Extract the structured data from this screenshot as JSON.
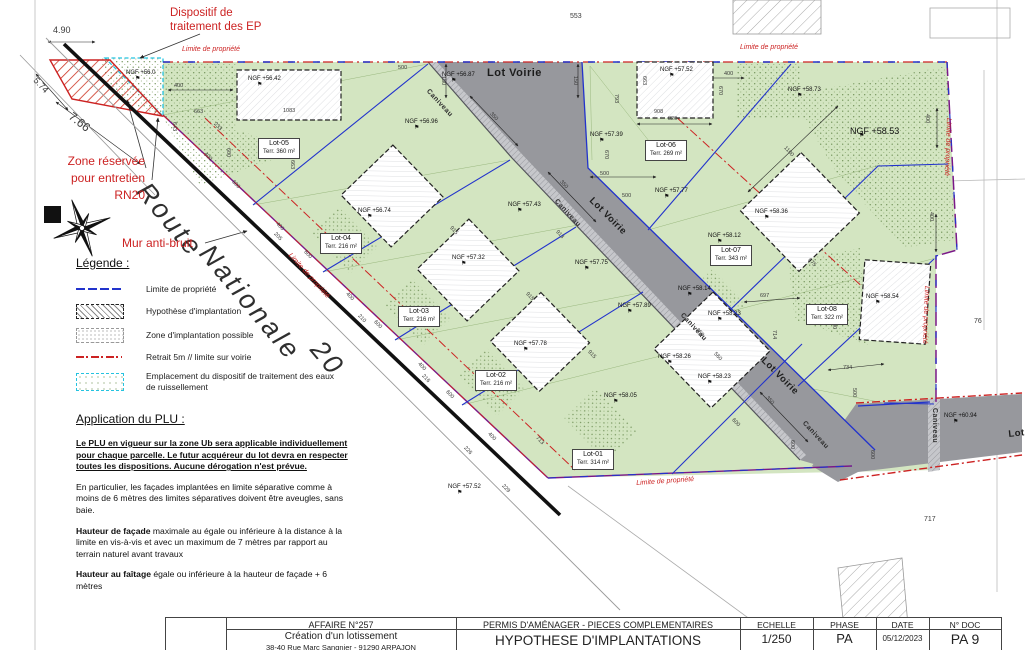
{
  "colors": {
    "red": "#cc2222",
    "blue": "#2233cc",
    "cyan": "#25c3e0",
    "purple": "#7a1888",
    "green_fill": "#d3e5c1",
    "road_gray": "#97989d"
  },
  "annotations": {
    "dispositif_l1": "Dispositif de",
    "dispositif_l2": "traitement des EP",
    "zone_l1": "Zone réservée",
    "zone_l2": "pour entretien",
    "zone_l3": "RN20",
    "mur": "Mur anti-bruit",
    "route": [
      "Route",
      "Nationale",
      "20"
    ]
  },
  "plan": {
    "limite_text": "Limite de propriété",
    "limite_positions": [
      [
        182,
        46,
        0
      ],
      [
        740,
        44,
        0
      ],
      [
        952,
        118,
        92
      ],
      [
        930,
        286,
        92
      ],
      [
        292,
        252,
        48
      ],
      [
        636,
        480,
        -4
      ]
    ],
    "lot_voirie_text": "Lot Voirie",
    "lot_voirie_positions": [
      [
        487,
        68,
        0,
        11
      ],
      [
        594,
        196,
        45,
        9.5
      ],
      [
        766,
        356,
        45,
        9.5
      ],
      [
        1008,
        430,
        -6,
        9.5
      ]
    ],
    "caniveau_text": "Caniveau",
    "caniveau_positions": [
      [
        430,
        88,
        47
      ],
      [
        558,
        198,
        47
      ],
      [
        684,
        312,
        47
      ],
      [
        806,
        420,
        47
      ],
      [
        938,
        408,
        90
      ]
    ],
    "route_positions": [
      [
        152,
        178,
        50
      ],
      [
        215,
        240,
        50
      ],
      [
        326,
        336,
        50
      ]
    ],
    "lots": [
      [
        "Lot-05",
        "Terr. 360 m²",
        258,
        138
      ],
      [
        "Lot-04",
        "Terr. 216 m²",
        320,
        233
      ],
      [
        "Lot-03",
        "Terr. 216 m²",
        398,
        306
      ],
      [
        "Lot-02",
        "Terr. 216 m²",
        475,
        370
      ],
      [
        "Lot-01",
        "Terr. 314 m²",
        572,
        449
      ],
      [
        "Lot-06",
        "Terr. 269 m²",
        645,
        140
      ],
      [
        "Lot-07",
        "Terr. 343 m²",
        710,
        245
      ],
      [
        "Lot-08",
        "Terr. 322 m²",
        806,
        304
      ]
    ],
    "ngf": [
      [
        "NGF +56.0",
        126,
        70
      ],
      [
        "NGF +56.42",
        248,
        76
      ],
      [
        "NGF +56.87",
        442,
        72
      ],
      [
        "NGF +57.52",
        660,
        67
      ],
      [
        "NGF +56.96",
        405,
        119
      ],
      [
        "NGF +57.39",
        590,
        132
      ],
      [
        "NGF +56.74",
        358,
        208
      ],
      [
        "NGF +57.43",
        508,
        202
      ],
      [
        "NGF +57.32",
        452,
        255
      ],
      [
        "NGF +57.77",
        655,
        188
      ],
      [
        "NGF +57.75",
        575,
        260
      ],
      [
        "NGF +57.78",
        514,
        341
      ],
      [
        "NGF +57.89",
        618,
        303
      ],
      [
        "NGF +58.26",
        658,
        354
      ],
      [
        "NGF +58.05",
        604,
        393
      ],
      [
        "NGF +57.52",
        448,
        484
      ],
      [
        "NGF +58.73",
        788,
        87
      ],
      [
        "NGF +58.53",
        850,
        127,
        9
      ],
      [
        "NGF +58.36",
        755,
        209
      ],
      [
        "NGF +58.12",
        708,
        233
      ],
      [
        "NGF +58.14",
        678,
        286
      ],
      [
        "NGF +58.23",
        708,
        311
      ],
      [
        "NGF +58.23",
        698,
        374
      ],
      [
        "NGF +58.54",
        866,
        294
      ],
      [
        "NGF +60.94",
        944,
        413
      ]
    ],
    "dims": [
      [
        "4.90",
        53,
        26,
        0,
        9
      ],
      [
        "5.74",
        38,
        76,
        47,
        9
      ],
      [
        "7.66",
        74,
        110,
        38,
        12
      ],
      [
        "400",
        174,
        84,
        0
      ],
      [
        "663",
        194,
        110,
        0
      ],
      [
        "1083",
        283,
        109,
        0
      ],
      [
        "643",
        176,
        122,
        90
      ],
      [
        "663",
        294,
        160,
        90
      ],
      [
        "600",
        230,
        148,
        90
      ],
      [
        "400",
        206,
        152,
        47
      ],
      [
        "600",
        234,
        180,
        47
      ],
      [
        "400",
        278,
        222,
        47
      ],
      [
        "600",
        306,
        250,
        47
      ],
      [
        "400",
        348,
        292,
        47
      ],
      [
        "600",
        376,
        320,
        47
      ],
      [
        "400",
        420,
        362,
        47
      ],
      [
        "600",
        448,
        390,
        47
      ],
      [
        "400",
        490,
        432,
        47
      ],
      [
        "915",
        452,
        226,
        47
      ],
      [
        "913",
        558,
        230,
        47
      ],
      [
        "915",
        528,
        292,
        47
      ],
      [
        "915",
        590,
        350,
        47
      ],
      [
        "713",
        538,
        436,
        47
      ],
      [
        "350",
        492,
        112,
        47
      ],
      [
        "350",
        562,
        180,
        47
      ],
      [
        "350",
        698,
        328,
        47
      ],
      [
        "350",
        768,
        396,
        47
      ],
      [
        "150",
        445,
        76,
        90
      ],
      [
        "150",
        577,
        76,
        90
      ],
      [
        "500",
        398,
        66,
        0
      ],
      [
        "500",
        600,
        172,
        0
      ],
      [
        "820",
        668,
        117,
        0
      ],
      [
        "908",
        654,
        110,
        0
      ],
      [
        "670",
        722,
        86,
        90
      ],
      [
        "670",
        608,
        150,
        90
      ],
      [
        "793",
        618,
        94,
        90
      ],
      [
        "663",
        646,
        76,
        90
      ],
      [
        "400",
        724,
        72,
        0
      ],
      [
        "400",
        929,
        114,
        90
      ],
      [
        "400",
        933,
        212,
        90
      ],
      [
        "500",
        622,
        194,
        0
      ],
      [
        "1100",
        786,
        146,
        47
      ],
      [
        "675",
        810,
        258,
        47
      ],
      [
        "697",
        760,
        294,
        0
      ],
      [
        "734",
        843,
        366,
        0
      ],
      [
        "714",
        776,
        330,
        90
      ],
      [
        "500",
        836,
        320,
        90
      ],
      [
        "560",
        716,
        352,
        47
      ],
      [
        "600",
        734,
        418,
        47
      ],
      [
        "600",
        794,
        440,
        90
      ],
      [
        "500",
        856,
        388,
        90
      ],
      [
        "600",
        874,
        450,
        90
      ],
      [
        "205",
        276,
        232,
        47
      ],
      [
        "210",
        360,
        314,
        47
      ],
      [
        "216",
        424,
        374,
        47
      ],
      [
        "226",
        466,
        446,
        47
      ],
      [
        "229",
        504,
        484,
        47
      ],
      [
        "233",
        216,
        122,
        47
      ],
      [
        "553",
        570,
        13,
        0,
        7
      ],
      [
        "717",
        924,
        516,
        0,
        7
      ],
      [
        "76",
        974,
        318,
        0,
        7
      ]
    ]
  },
  "legend": {
    "title": "Légende :",
    "items": [
      {
        "label": "Limite de propriété"
      },
      {
        "label": "Hypothèse d'implantation"
      },
      {
        "label": "Zone d'implantation possible"
      },
      {
        "label": "Retrait 5m // limite sur voirie"
      },
      {
        "label": "Emplacement du dispositif de traitement des eaux de ruissellement"
      }
    ]
  },
  "plu": {
    "title": "Application du PLU :",
    "p1": "Le PLU en vigueur sur la zone Ub sera applicable individuellement pour chaque parcelle. Le futur acquéreur du lot devra en respecter toutes les dispositions. Aucune dérogation n'est prévue.",
    "p2": "En particulier, les façades implantées en limite séparative comme à  moins de 6 mètres des limites séparatives doivent être aveugles, sans baie.",
    "p3_bold": "Hauteur de façade",
    "p3_rest": " maximale au égale ou inférieure à la distance à la limite en vis-à-vis et avec un maximum de 7 mètres par rapport au terrain naturel avant travaux",
    "p4_bold": "Hauteur au faîtage",
    "p4_rest": " égale ou inférieure à la hauteur de façade + 6 mètres"
  },
  "titleblock": {
    "affaire": "AFFAIRE N°257",
    "project": "Création d'un lotissement",
    "address": "38-40 Rue Marc Sangnier - 91290 ARPAJON",
    "permis": "PERMIS D'AMÉNAGER - PIECES COMPLEMENTAIRES",
    "doc_title": "HYPOTHESE D'IMPLANTATIONS",
    "echelle_label": "ECHELLE",
    "echelle": "1/250",
    "phase_label": "PHASE",
    "phase": "PA",
    "date_label": "DATE",
    "date": "05/12/2023",
    "ndoc_label": "N° DOC",
    "ndoc": "PA 9"
  }
}
